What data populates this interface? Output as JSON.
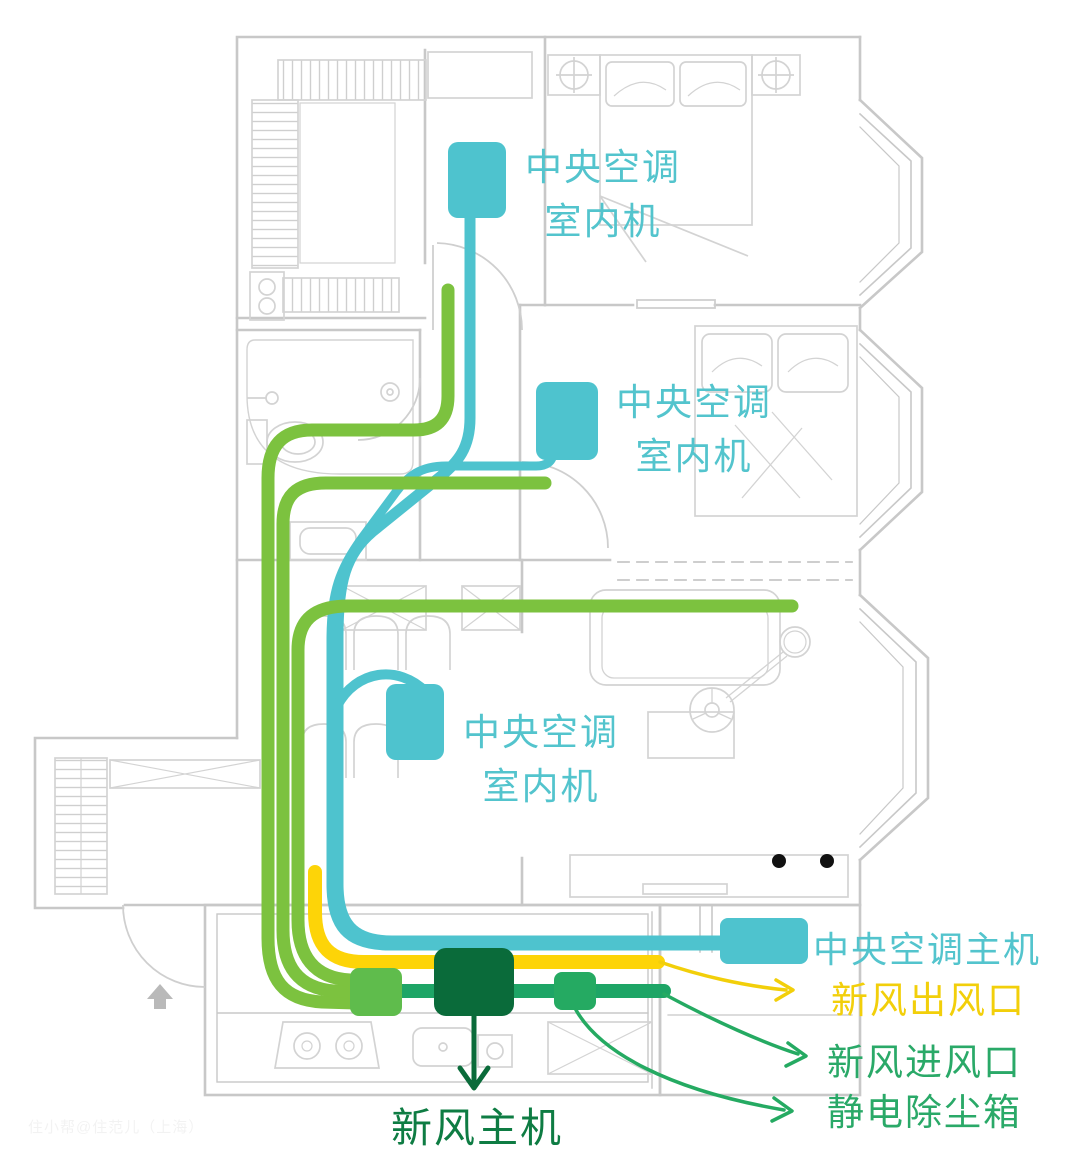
{
  "labels": {
    "indoor_unit_line1": "中央空调",
    "indoor_unit_line2": "室内机",
    "main_ac": "中央空调主机",
    "fresh_out": "新风出风口",
    "fresh_in": "新风进风口",
    "dust_box": "静电除尘箱",
    "fresh_main": "新风主机"
  },
  "watermark": "住小帮@住范儿（上海）",
  "colors": {
    "ac_teal": "#4ec3ce",
    "fresh_pipe_light_green": "#7cc23f",
    "fresh_junction_green": "#5fbc4c",
    "fresh_line_green": "#1ea566",
    "fresh_main_dark_green": "#0a6b3a",
    "fresh_outlet_yellow": "#fdd408",
    "plan_gray": "#cccccc"
  },
  "diagram": {
    "type": "apartment-floor-plan-hvac-routing",
    "indoor_unit_count": 3,
    "black_ceiling_dots": 2
  }
}
